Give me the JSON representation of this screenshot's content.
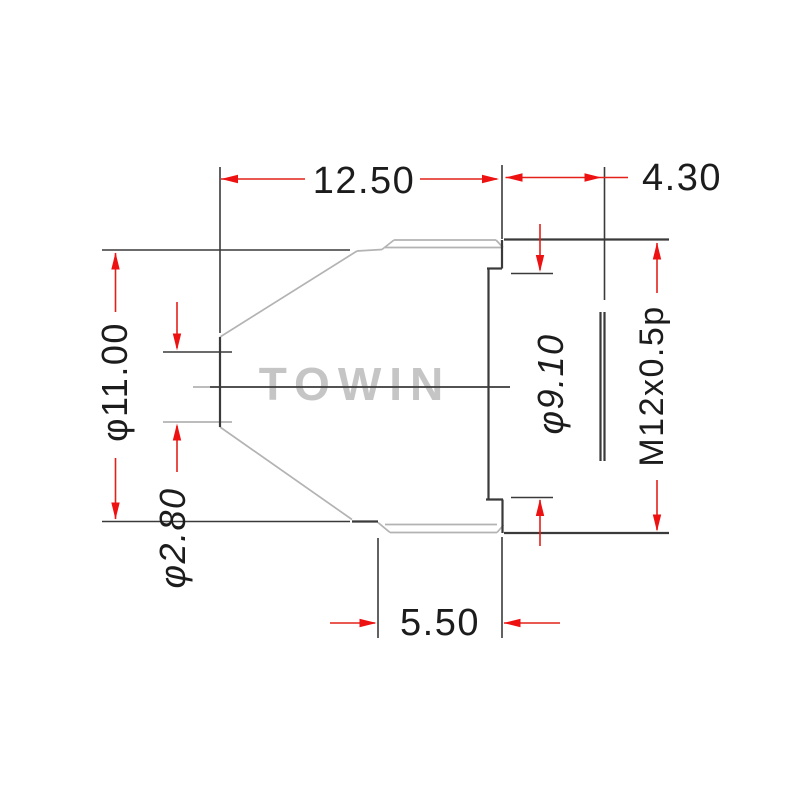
{
  "drawing": {
    "watermark": "TOWIN",
    "dimensions": {
      "front_length": "12.50",
      "thread_length": "4.30",
      "barrel_outer_diameter": "φ11.00",
      "aperture_diameter": "φ2.80",
      "neck_diameter": "φ9.10",
      "thread_spec": "M12x0.5p",
      "front_cylinder_length": "5.50"
    },
    "colors": {
      "dimension_red_line": "#e32119",
      "dimension_red_arrow": "#ee1111",
      "outline_dark": "#3a3a3a",
      "outline_light": "#b3b3b3",
      "text": "#1c1c1c",
      "watermark_gray": "#c5c5c5",
      "background": "#ffffff"
    }
  }
}
